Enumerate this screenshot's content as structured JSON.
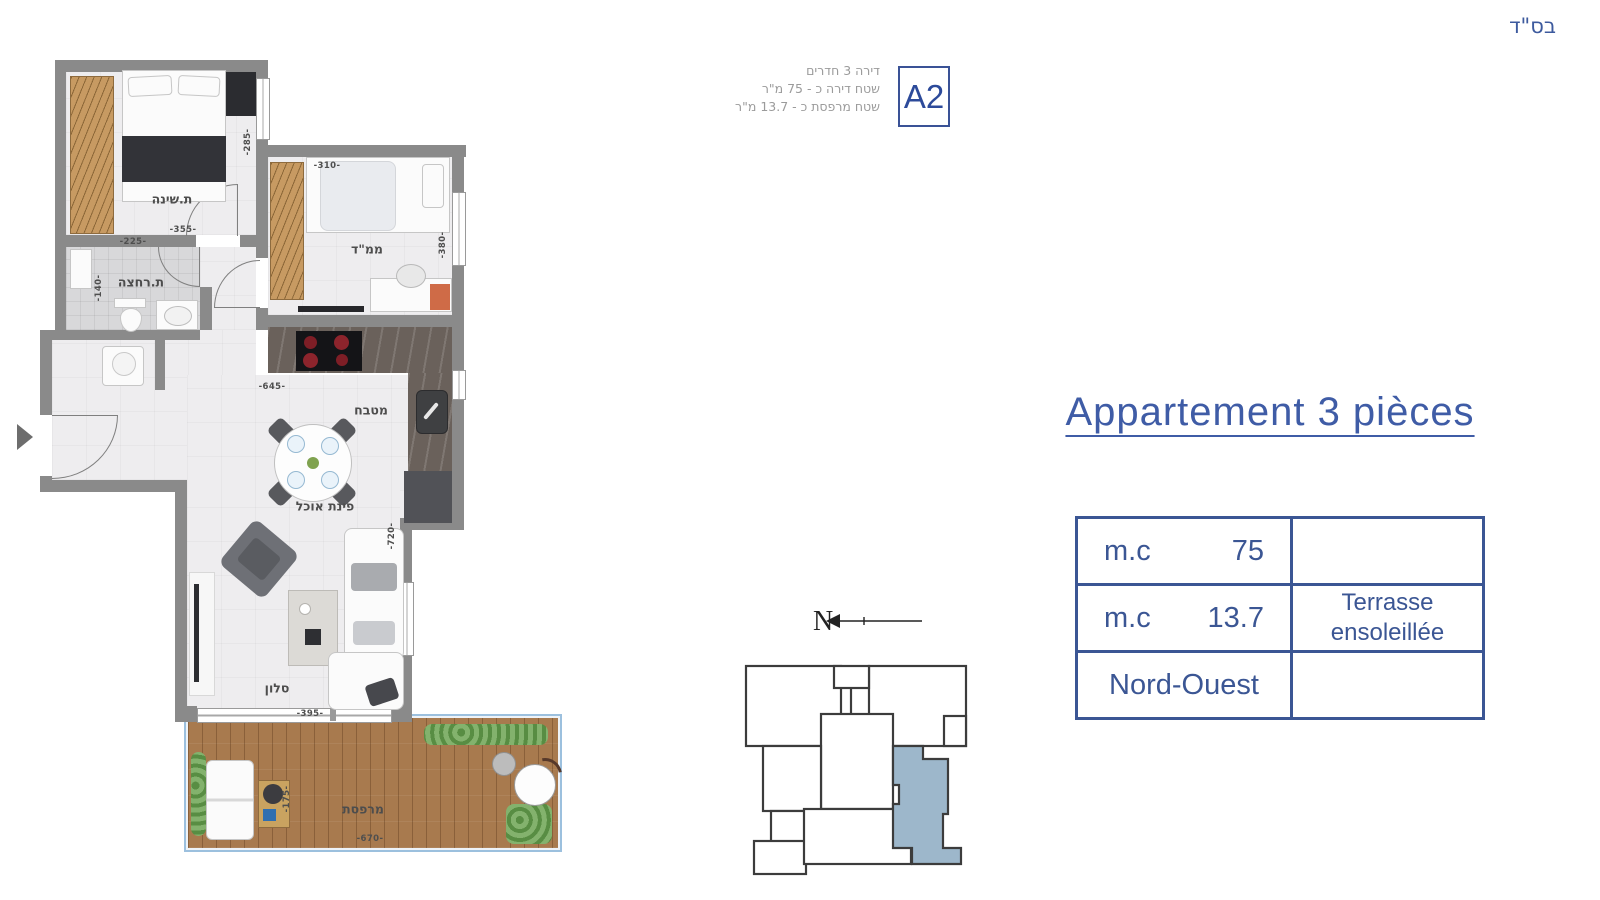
{
  "page": {
    "bsd": "בס\"ד"
  },
  "header": {
    "line1": "דירה 3 חדרים",
    "line2": "שטח דירה כ - 75 מ\"ר",
    "line3": "שטח מרפסת כ - 13.7 מ\"ר",
    "badge": "A2"
  },
  "title": {
    "text": "Appartement 3 pièces"
  },
  "spec_table": {
    "row1": {
      "label": "m.c",
      "value": "75",
      "note": ""
    },
    "row2": {
      "label": "m.c",
      "value": "13.7",
      "note": "Terrasse ensoleillée"
    },
    "row3": {
      "label": "Nord-Ouest",
      "value": "",
      "note": ""
    }
  },
  "compass": {
    "north": "N"
  },
  "plan": {
    "labels": {
      "bedroom": "ת.שינה",
      "mamad": "ממ\"ד",
      "bathroom": "ת.רחצה",
      "kitchen": "מטבח",
      "dining": "פינת אוכל",
      "living": "סלון",
      "terrace": "מרפסת"
    },
    "dims": {
      "bedroom_w": "-355-",
      "bedroom_h": "-285-",
      "bath_w": "-225-",
      "bath_h": "-140-",
      "mamad_w": "-310-",
      "mamad_h": "-380-",
      "kitchen_w": "-645-",
      "living_w": "-395-",
      "living_h": "-720-",
      "terrace_w": "-670-",
      "terrace_h": "-175-"
    }
  },
  "colors": {
    "accent": "#3f5ca6",
    "table_border": "#3b5694",
    "wall": "#8a8a8a",
    "unit_fill": "#9db7cb",
    "deck": "#a87a4e"
  }
}
